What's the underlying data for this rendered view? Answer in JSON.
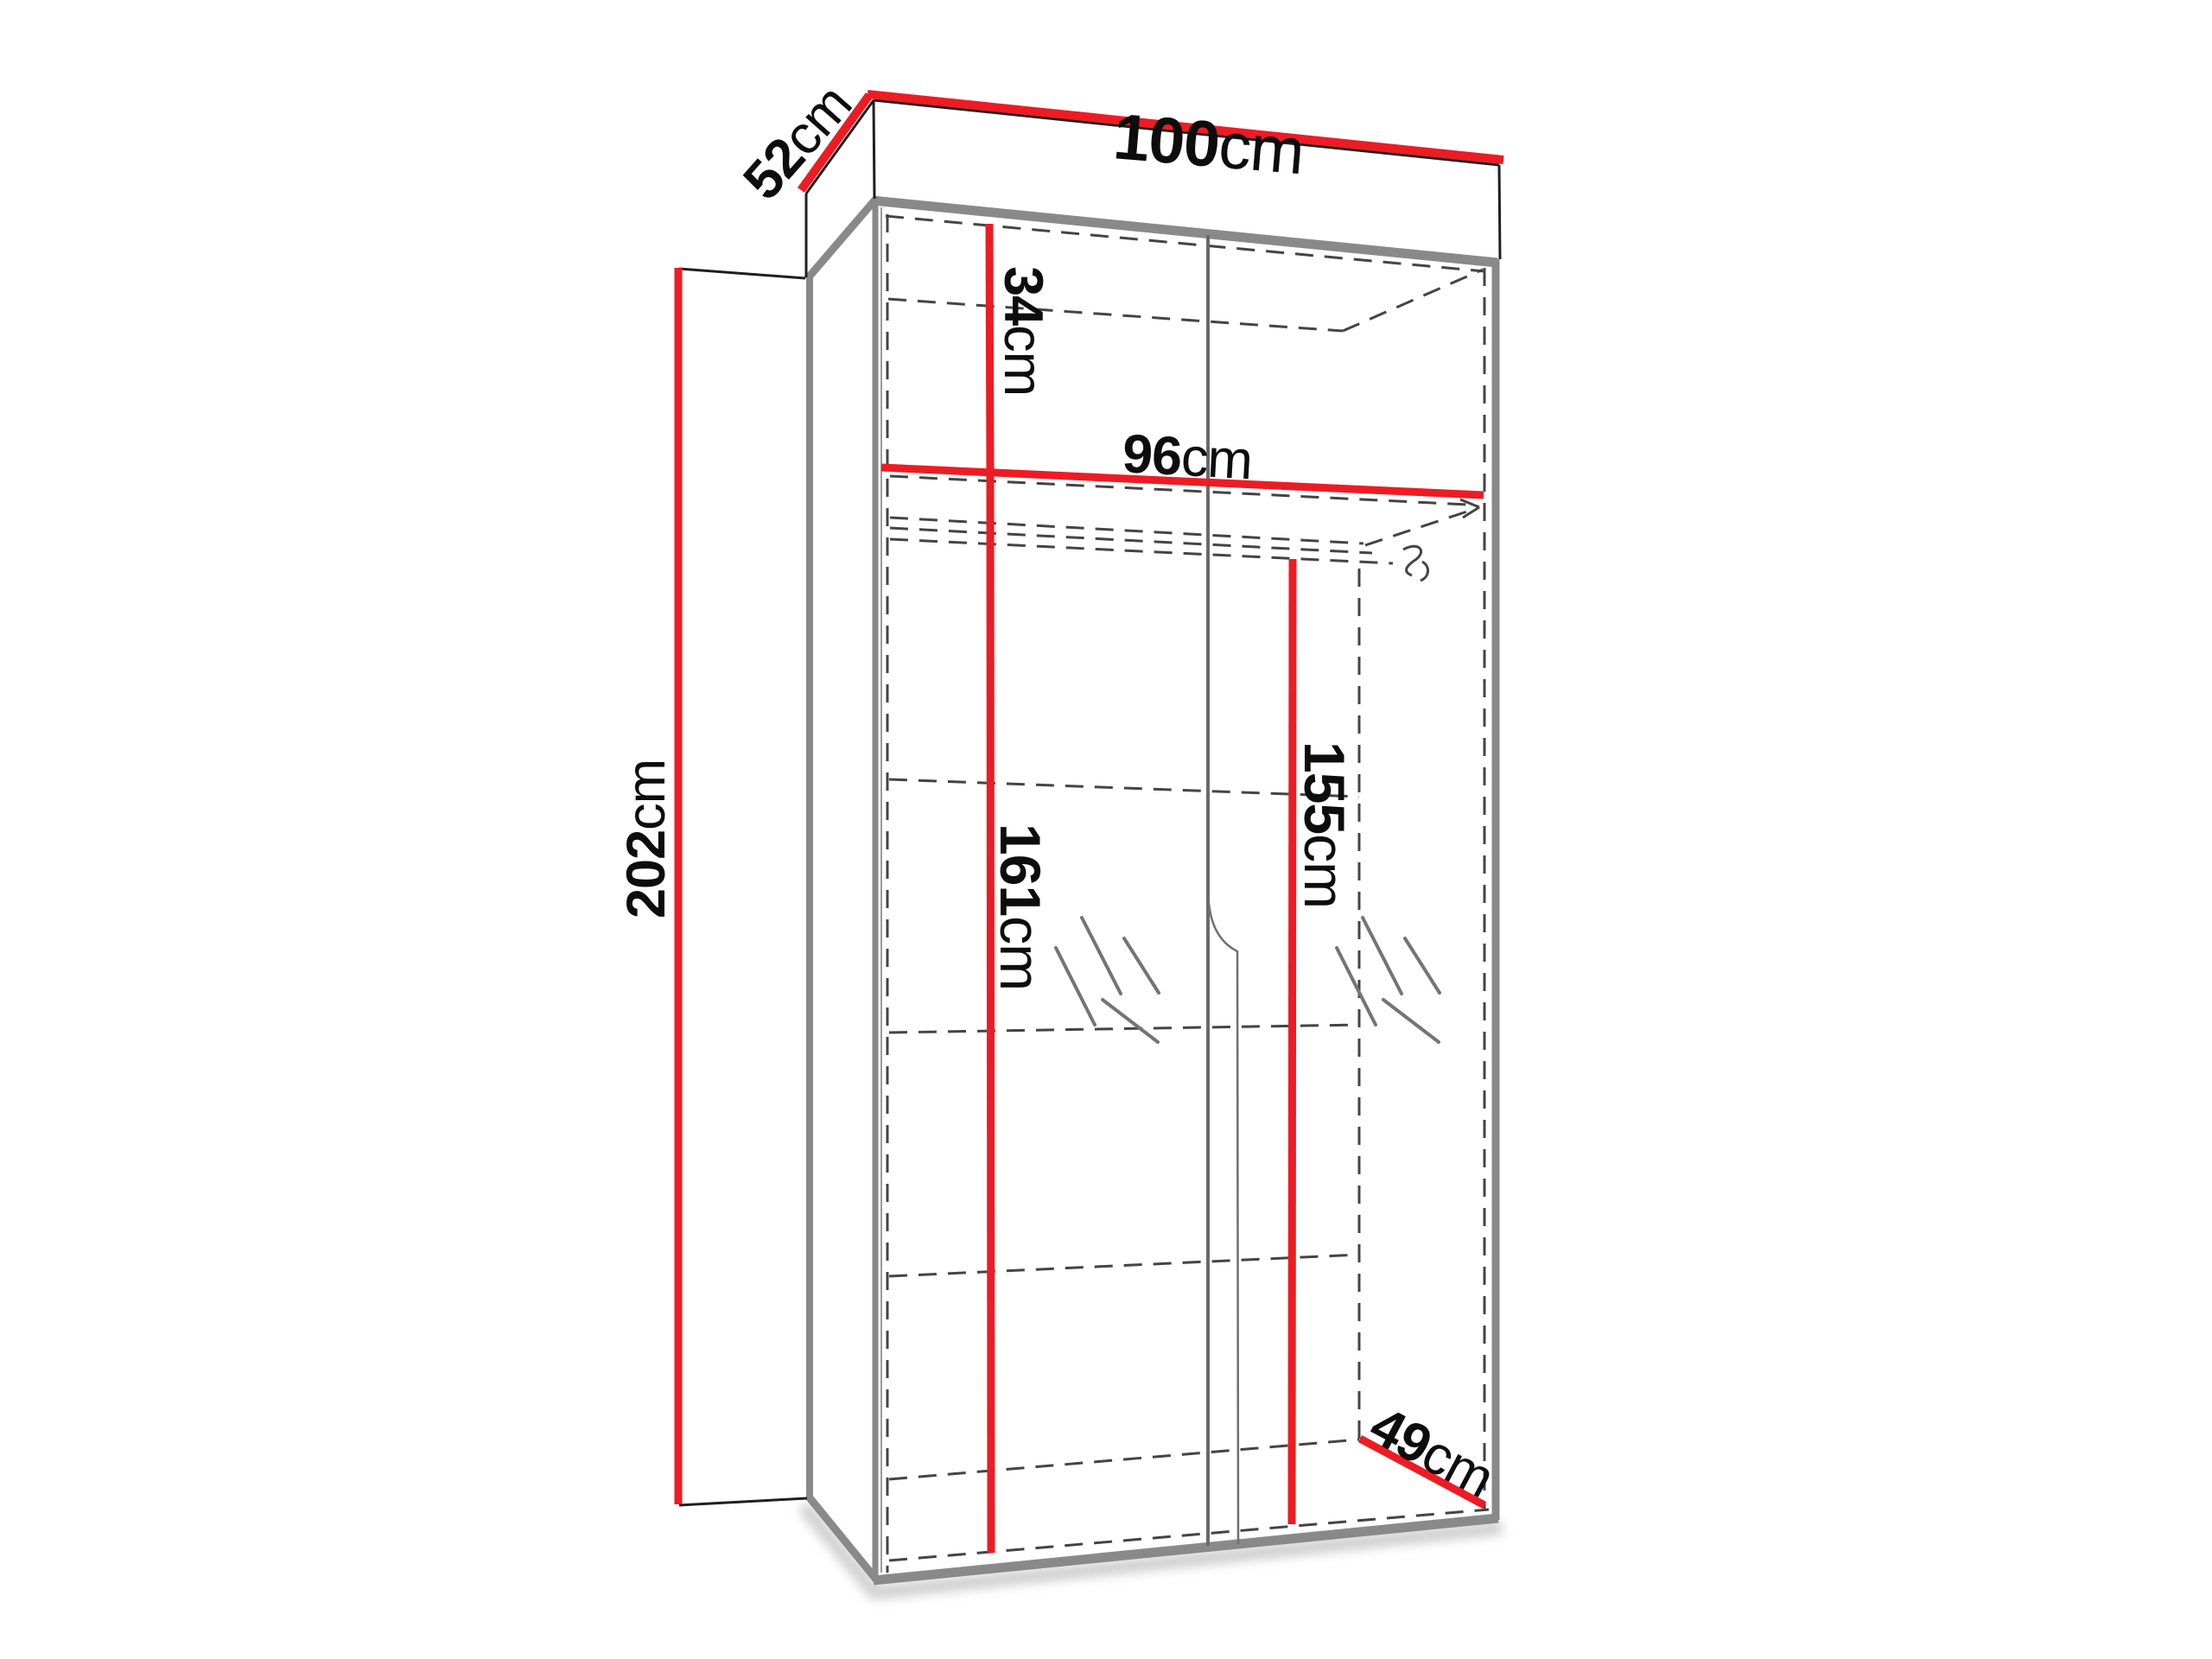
{
  "title": "Wardrobe dimension diagram",
  "colors": {
    "background": "#ffffff",
    "dimension_line": "#ec1c24",
    "frame_gray": "#898989",
    "outline_black": "#1f1f1f",
    "hidden_dashed": "#444444",
    "label_text": "#0d0d0d"
  },
  "dimensions": {
    "width": {
      "value": "100",
      "unit": "cm"
    },
    "depth": {
      "value": "52",
      "unit": "cm"
    },
    "height": {
      "value": "202",
      "unit": "cm"
    },
    "top_section": {
      "value": "34",
      "unit": "cm"
    },
    "interior_width": {
      "value": "96",
      "unit": "cm"
    },
    "left_interior": {
      "value": "161",
      "unit": "cm"
    },
    "right_interior": {
      "value": "155",
      "unit": "cm"
    },
    "interior_depth": {
      "value": "49",
      "unit": "cm"
    }
  }
}
